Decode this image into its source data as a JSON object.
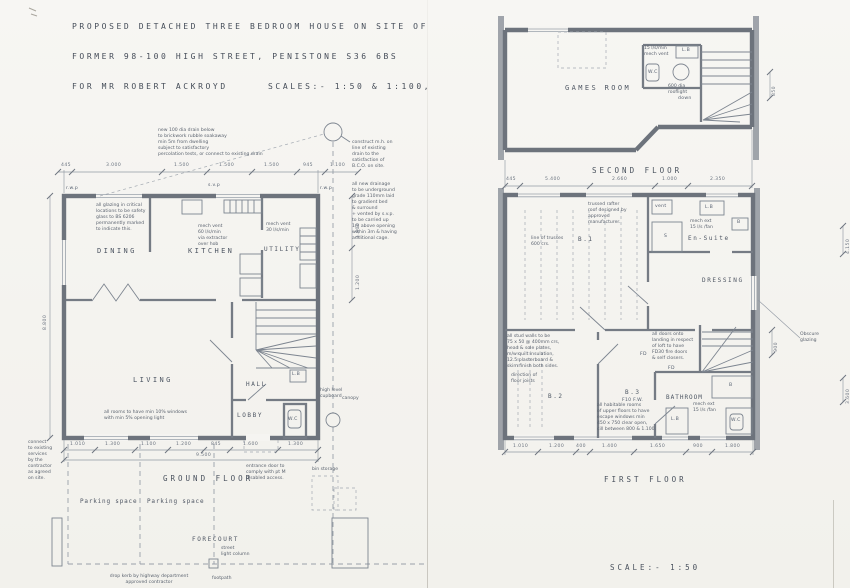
{
  "title_block": {
    "line1": "PROPOSED DETACHED THREE BEDROOM HOUSE ON SITE OF",
    "line2": "FORMER 98-100 HIGH STREET, PENISTONE S36 6BS",
    "line3": "FOR MR ROBERT ACKROYD",
    "scales": "SCALES:- 1:50 & 1:100,"
  },
  "ground_floor": {
    "floor_label": "GROUND  FLOOR",
    "rooms": {
      "dining": "DINING",
      "kitchen": "KITCHEN",
      "utility": "UTILITY",
      "living": "LIVING",
      "hall": "HALL",
      "lobby": "LOBBY",
      "wc": "W.C",
      "lb": "L.B"
    },
    "notes": {
      "soakaway": "new 100 dia drain below\nto brickwork rubble soakaway\nmin 5m from dwelling\nsubject to satisfactory\npercolation tests, or connect to existing drain",
      "manhole": "construct m.h. on\nline of existing\ndrain to the\nsatisfaction of\nB.C.O. on site.",
      "drainage": "all new drainage\nto be underground\ngrade 110mm laid\nto gradient bed\n& surround\n+ vented by s.v.p.\nto be carried up\n1m above opening\nwithin 3m & having\nadditional cage.",
      "glazing": "all glazing in critical\nlocations to be safety\nglass to BS 6206\npermanently marked\nto indicate this.",
      "kitchen_vent": "mech vent\n60 l/s/min\nvia extractor\nover hob",
      "utility_vent": "mech vent\n30 l/s/min",
      "windows": "all rooms to have min 10% windows\nwith min 5% opening light",
      "cupboard": "high level\ncupboard",
      "canopy": "canopy",
      "entrance": "entrance door to\ncomply with pt M\ndisabled access.",
      "connect": "connect\nto existing\nservices\nby the\ncontractor\nas agreed\non site.",
      "rwp1": "r.w.p",
      "svp": "s.v.p",
      "rwp2": "r.w.p"
    },
    "site": {
      "parking1": "Parking space",
      "parking2": "Parking space",
      "forecourt": "FORECOURT",
      "bin": "bin storage",
      "street_light": "street\nlight column",
      "footpath": "footpath",
      "drop_kerb": "drop kerb by highway department\napproved contractor"
    },
    "dims": {
      "top": [
        "445",
        "3.000",
        "1.500",
        "1.500",
        "1.500",
        "945",
        "1.100"
      ],
      "bottom": [
        "1.010",
        "1.300",
        "1.100",
        "1.200",
        "845",
        "1.600",
        "1.300"
      ],
      "total": "9.500",
      "left": "8.800",
      "right_upper": "1.800",
      "right_lower": "1.200"
    }
  },
  "second_floor": {
    "floor_label": "SECOND  FLOOR",
    "rooms": {
      "games": "GAMES ROOM",
      "wc": "W.C",
      "lb": "L.B"
    },
    "notes": {
      "vent": "15 l/s/min\nmech vent",
      "rooflight": "600 dia\nrooflight",
      "down": "down"
    },
    "dims": {
      "bottom": [
        "445",
        "5.400",
        "2.660",
        "1.000",
        "2.350"
      ],
      "right": "850"
    }
  },
  "first_floor": {
    "floor_label": "FIRST  FLOOR",
    "rooms": {
      "b1": "B.1",
      "b2": "B.2",
      "b3": "B.3",
      "b3_sub": "F10 F.W.",
      "ensuite": "En-Suite",
      "dressing": "DRESSING",
      "bathroom": "BATHROOM",
      "wc": "W.C",
      "lb1": "L.B",
      "lb2": "L.B",
      "shower": "S",
      "bath": "B",
      "basin": "B",
      "vent_box": "vent"
    },
    "notes": {
      "truss": "trussed rafter\nroof designed by\napproved\nmanufacturer.",
      "truss_lines": "line of trusses\n600 crs.",
      "stud": "all stud walls to be\n75 x 50 @ 400mm crs,\nhead & sole plates,\nm/w quilt insulation,\n12.5 plasterboard &\nskim finish both sides.",
      "joists": "direction of\nfloor joists",
      "escape": "all habitable rooms\nof upper floors to have\nescape windows min\n450 x 750 clear open,\ncill between 800 & 1.100.",
      "fire_doors": "all doors onto\nlanding in respect\nof loft to have\nFD30 fire doors\n& self closers.",
      "ensuite_vent": "mech ext\n15 l/s /fan",
      "bath_vent": "mech ext\n15 l/s /fan",
      "obscure": "Obscure\nglazing",
      "fd1": "FD",
      "fd2": "FD"
    },
    "dims": {
      "bottom": [
        "1.010",
        "1.200",
        "400",
        "1.400",
        "1.650",
        "900",
        "1.800"
      ],
      "right_900": "900",
      "right_4150": "4.150",
      "right_3600": "3.600"
    }
  },
  "scale_note": "SCALE:- 1:50"
}
